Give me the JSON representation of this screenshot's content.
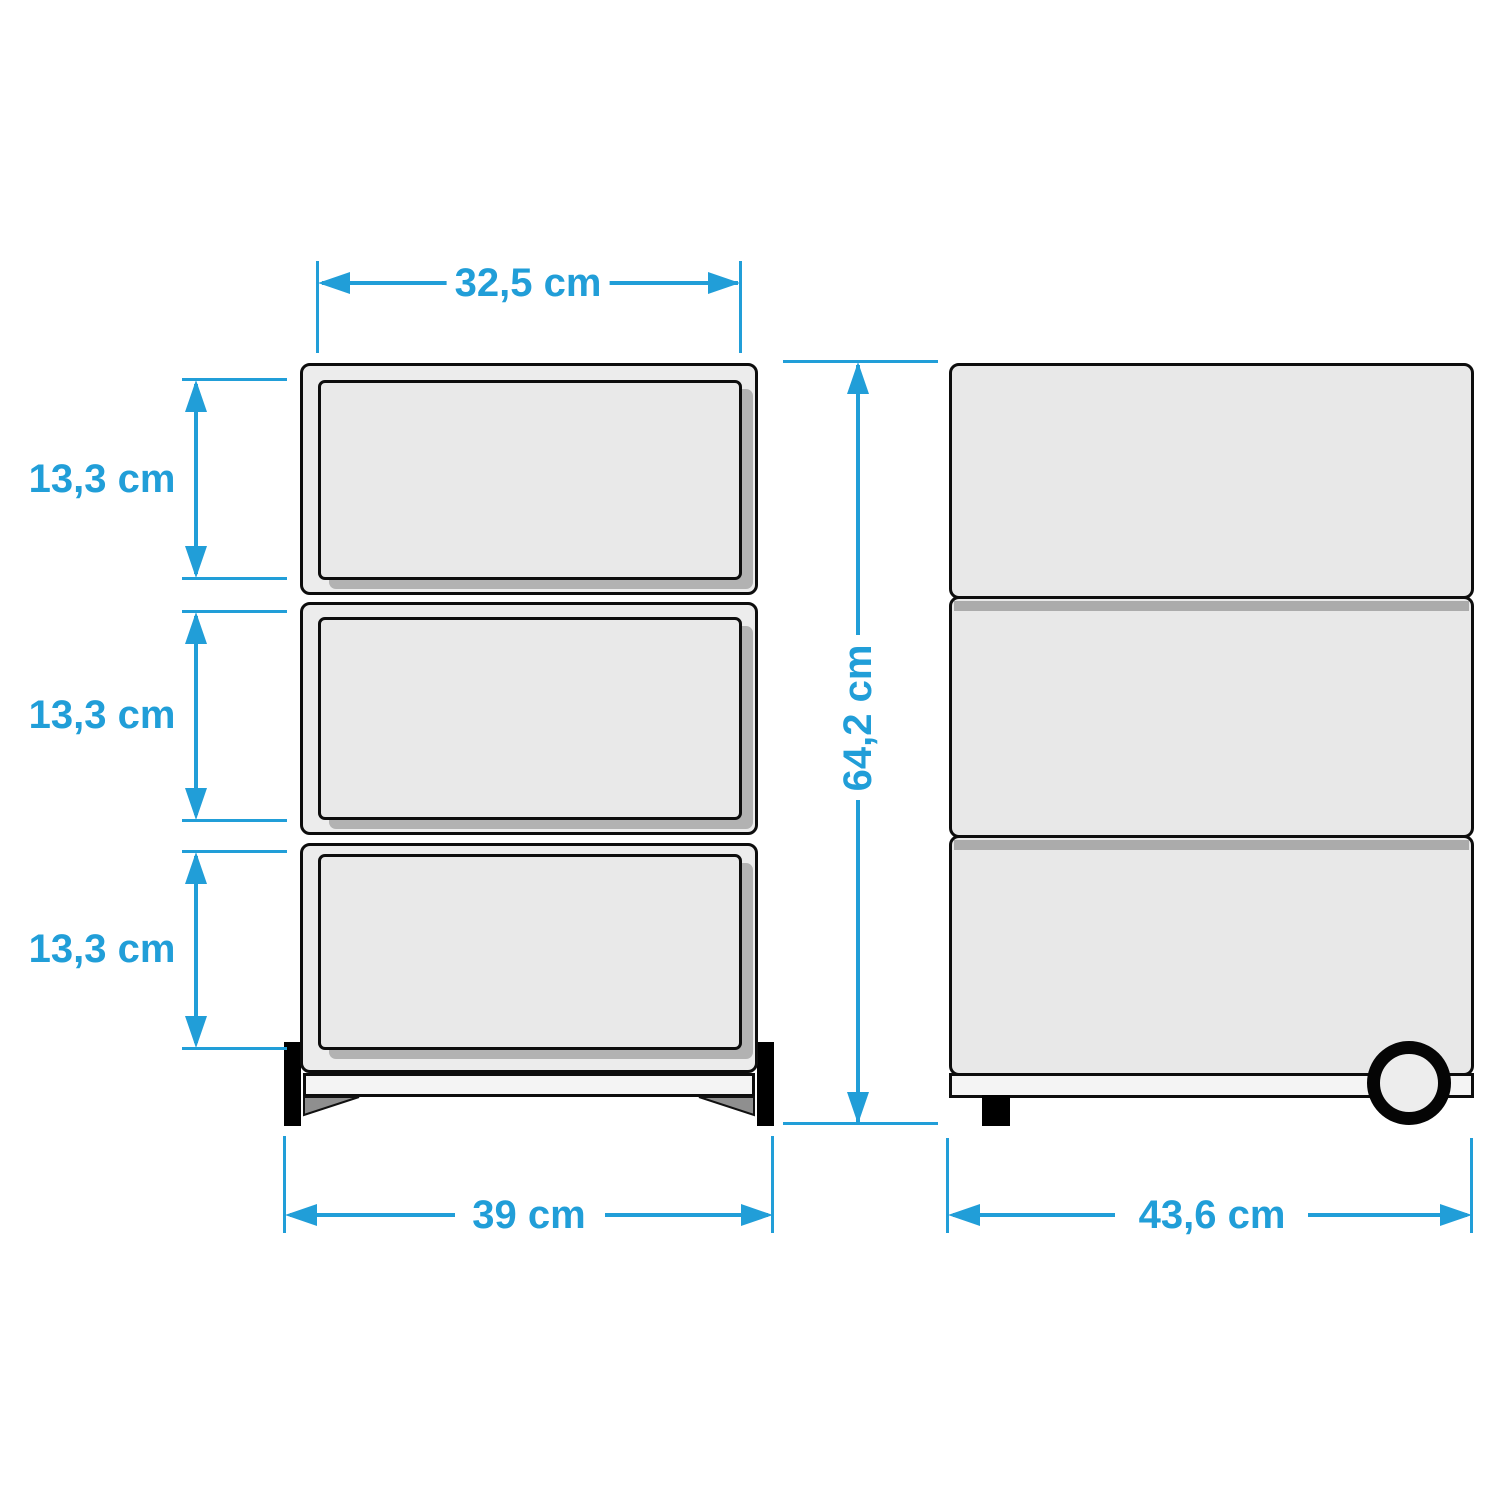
{
  "diagram": {
    "type": "furniture-dimension-drawing",
    "subject": "3-drawer rolling cabinet, front and side orthographic views",
    "unit": "cm",
    "accent_color": "#219ed8",
    "front_view": {
      "drawer_count": 3,
      "dim_top_width": "32,5 cm",
      "dim_drawer_1_height": "13,3 cm",
      "dim_drawer_2_height": "13,3 cm",
      "dim_drawer_3_height": "13,3 cm",
      "dim_bottom_width": "39 cm",
      "dim_total_height": "64,2 cm"
    },
    "side_view": {
      "section_count": 3,
      "dim_depth": "43,6 cm"
    }
  }
}
